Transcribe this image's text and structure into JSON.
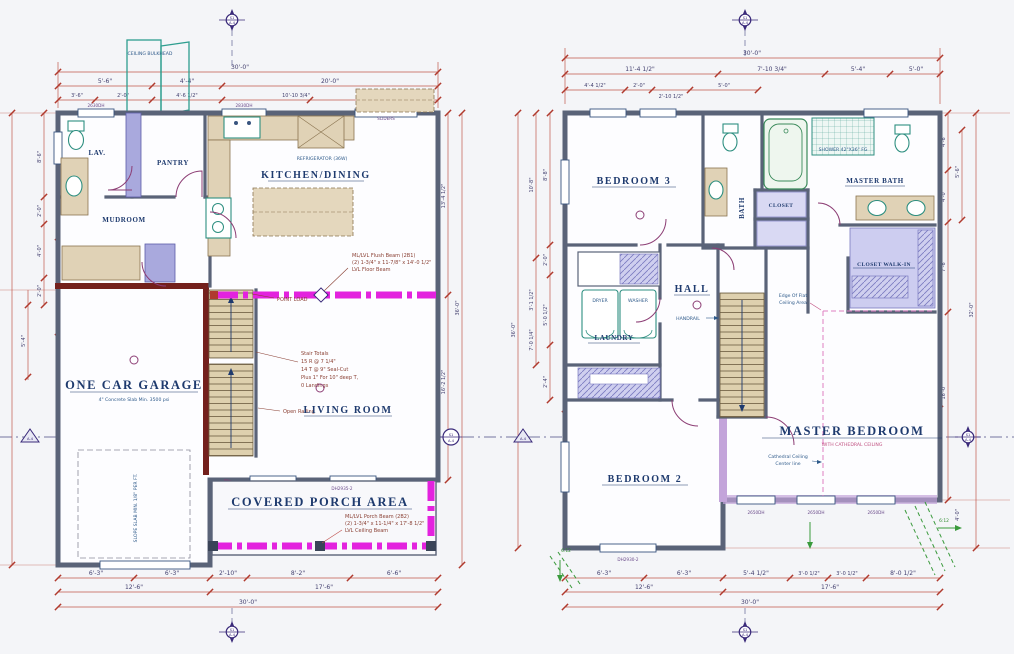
{
  "sheet": {
    "bg": "#f4f5f8",
    "wall_color": "#5a6378",
    "dim_color": "#c2574b",
    "beam_color": "#e322de",
    "accent_green": "#3a9a3c"
  },
  "markers": {
    "s1": "S1",
    "a4": "A-4"
  },
  "pitch": "6:12",
  "plan1": {
    "rooms": {
      "lav": "LAV.",
      "pantry": "PANTRY",
      "kitchen": "KITCHEN/DINING",
      "mudroom": "MUDROOM",
      "garage": "ONE CAR GARAGE",
      "garage_note": "4\" Concrete Slab Min. 3500 psi",
      "living": "LIVING ROOM",
      "porch": "COVERED PORCH AREA"
    },
    "notes": {
      "bulkhead": "CEILING BULKHEAD",
      "beam1": "ML/LVL Flush Beam (2B1)",
      "beam2": "(2) 1-3/4\" x 11-7/8\" x 14'-0 1/2\"",
      "beam3": "LVL Floor Beam",
      "point_load": "POINT LOAD",
      "stair1": "Stair Totals",
      "stair2": "15 R @ 7 1/4\"",
      "stair3": "14 T @ 9\" Seal-Cut",
      "stair4": "Plus 1\" For 10\" deep T,",
      "stair5": "0 Landings",
      "open_railing": "Open Railing",
      "slope": "SLOPE SLAB MIN. 1/8\" PER FT.",
      "pbeam1": "ML/LVL Porch Beam (2B2)",
      "pbeam2": "(2) 1-3/4\" x 11-1/4\" x 17'-8 1/2\"",
      "pbeam3": "LVL Ceiling Beam",
      "fridge": "REFRIGERATOR (36W)"
    },
    "tags": {
      "w1": "2630DH",
      "w2": "2830DH",
      "sliders": "SLIDERS",
      "porch_door": "DH2935-2"
    },
    "dims": {
      "top1": "30'-0\"",
      "top2": [
        "5'-6\"",
        "4'-4\"",
        "20'-0\""
      ],
      "top3": [
        "3'-6\"",
        "2'-0\"",
        "4'-6 1/2\"",
        "10'-10 3/4\"",
        "4'-5\""
      ],
      "bot1": [
        "6'-3\"",
        "6'-3\"",
        "2'-10\"",
        "8'-2\"",
        "6'-6\""
      ],
      "bot2": [
        "12'-6\"",
        "17'-6\""
      ],
      "bot3": "30'-0\"",
      "left": [
        "8'-6\"",
        "2'-0\"",
        "4'-0\"",
        "2'-0\"",
        "5'-4\""
      ],
      "right": [
        "13'-4 1/2\"",
        "16'-2 1/2\"",
        "36'-0\""
      ],
      "mudroom": [
        "6'-11 3/4\"",
        "2'-4\"",
        "5'-11\""
      ],
      "beam": "14'-2\"",
      "mid": [
        "8'-11 1/4\"",
        "14'-2 1/4\""
      ],
      "garage_w": "12'-0 1/2\"",
      "living_w": "17'-11 1/2\""
    }
  },
  "plan2": {
    "rooms": {
      "bed3": "BEDROOM 3",
      "bath": "BATH",
      "master_bath": "MASTER BATH",
      "hall": "HALL",
      "laundry": "LAUNDRY",
      "dryer": "DRYER",
      "washer": "WASHER",
      "closet": "CLOSET",
      "walkin": "CLOSET WALK-IN",
      "master": "MASTER BEDROOM",
      "master_sub": "WITH CATHEDRAL CEILING",
      "bed2": "BEDROOM 2"
    },
    "notes": {
      "cath1": "Cathedral Ceiling",
      "cath2": "Center line",
      "edge1": "Edge Of Flat",
      "edge2": "Ceiling Area",
      "handrail": "HANDRAIL",
      "shower": "SHOWER 42\"X36\" FG"
    },
    "tags": {
      "w1": "2650DH",
      "w2": "2650DH",
      "w3": "2650DH",
      "w4": "DH2930-2"
    },
    "dims": {
      "top1": "30'-0\"",
      "top2": [
        "11'-4 1/2\"",
        "7'-10 3/4\"",
        "5'-4\"",
        "5'-0\""
      ],
      "top3": [
        "4'-4 1/2\"",
        "2'-0\"",
        "2'-10 1/2\"",
        "5'-0\""
      ],
      "bot1": [
        "6'-3\"",
        "6'-3\"",
        "5'-4 1/2\"",
        "3'-0 1/2\"",
        "3'-0 1/2\"",
        "8'-0 1/2\""
      ],
      "bot2": [
        "12'-6\"",
        "17'-6\""
      ],
      "bot3": "30'-0\"",
      "left": [
        "8'-8\"",
        "10'-8\"",
        "2'-0\"",
        "3'-1 1/2\"",
        "5'-0 1/2\"",
        "7'-0 1/4\"",
        "2'-4\"",
        "36'-0\""
      ],
      "right": [
        "4'-6\"",
        "5'-6\"",
        "4'-0\"",
        "7'-6\"",
        "16'-0\"",
        "32'-0\"",
        "4'-0\""
      ],
      "inner": [
        "8'-5 1/4\"",
        "4'-0\"",
        "3'-6 1/2\"",
        "14'-0 1/4\""
      ],
      "master": [
        "8'-4 3/4\"",
        "8'-4 3/4\""
      ],
      "closet": [
        "2'-2 3/4\"",
        "2'-2 3/4\""
      ]
    }
  }
}
